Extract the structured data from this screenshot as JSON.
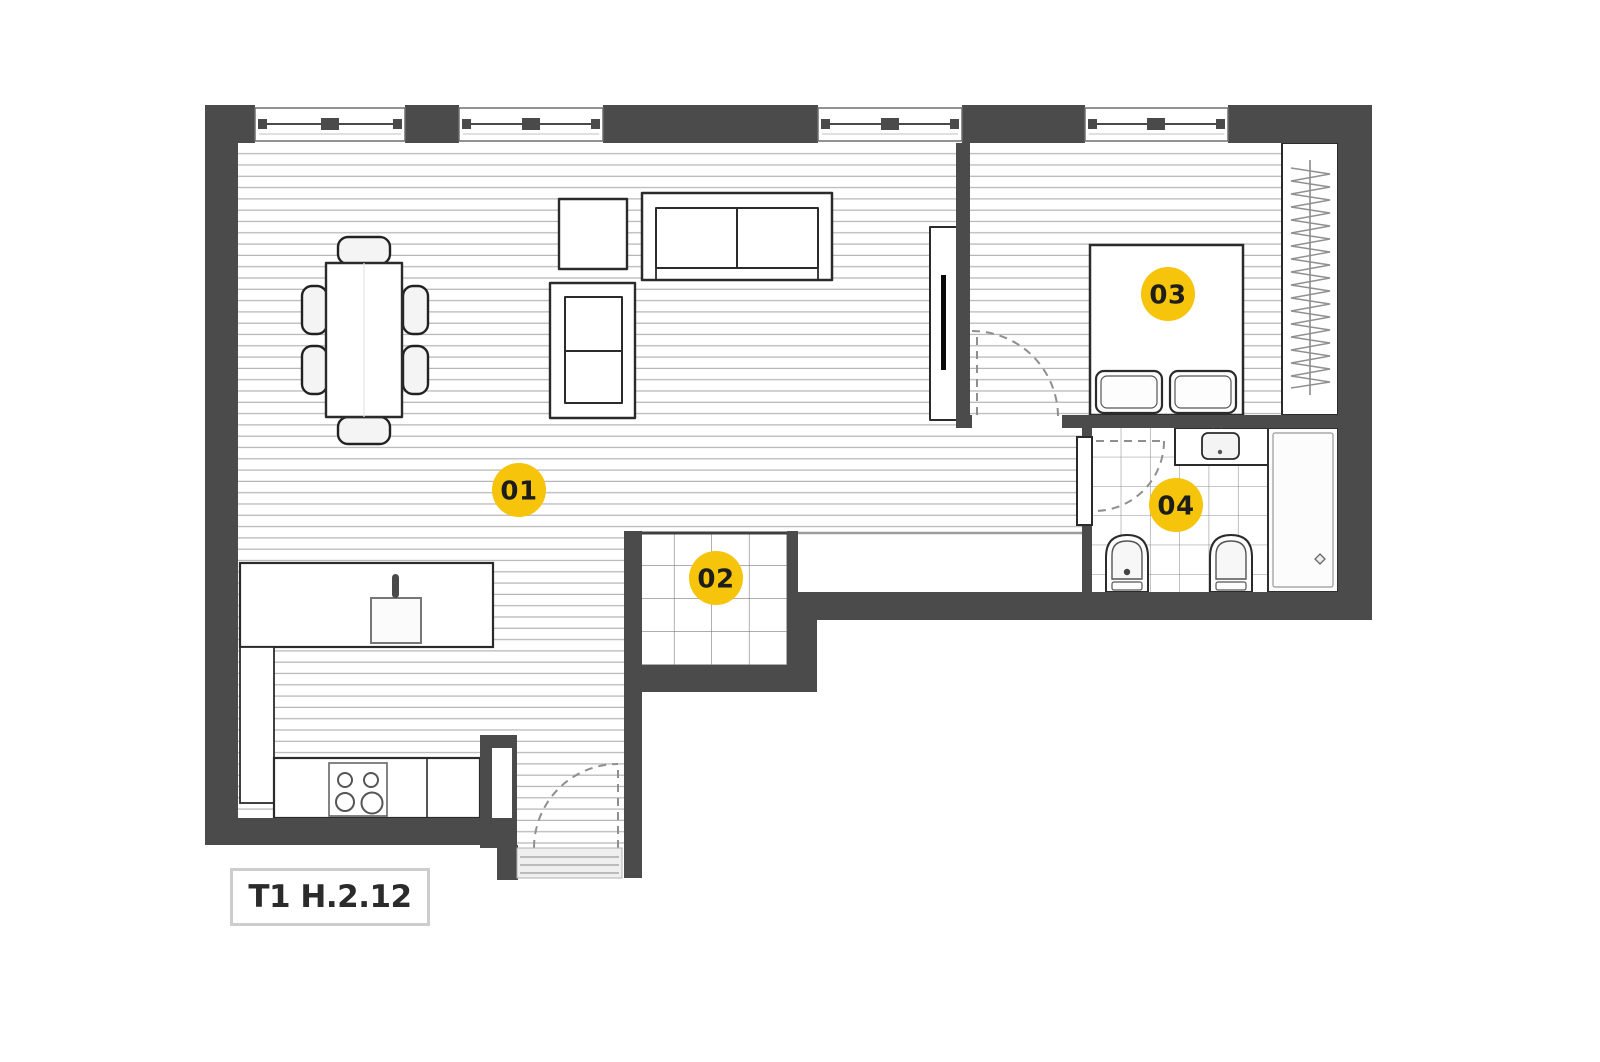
{
  "plan": {
    "title": "T1 H.2.12",
    "rooms": [
      {
        "label": "01"
      },
      {
        "label": "02"
      },
      {
        "label": "03"
      },
      {
        "label": "04"
      }
    ],
    "colors": {
      "wall": "#4B4B4B",
      "marker_fill": "#F5C40B",
      "marker_text": "#1D1D1B",
      "floor_line": "#B6B6B6"
    }
  }
}
